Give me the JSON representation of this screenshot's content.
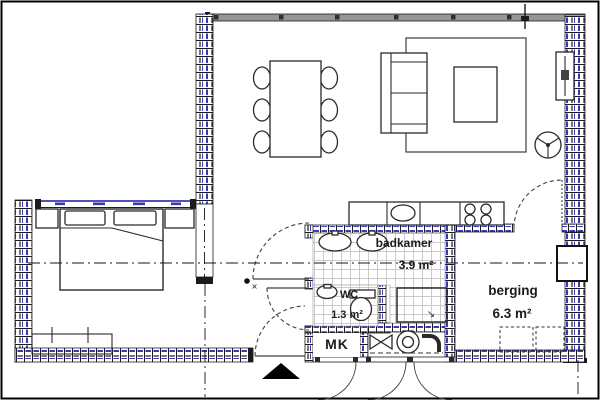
{
  "rooms": {
    "badkamer": {
      "label": "badkamer",
      "area": "3.9 m²"
    },
    "wc": {
      "label": "WC",
      "area": "1.3 m²"
    },
    "berging": {
      "label": "berging",
      "area": "6.3 m²"
    },
    "mk": {
      "label": "MK"
    }
  },
  "symbols": {
    "drain_arrow": "↘",
    "fixture_names": [
      "double-bed",
      "pillow",
      "nightstand",
      "dresser",
      "dining-table",
      "dining-chair",
      "sofa",
      "rug",
      "coffee-table",
      "radiator",
      "ventilation-symbol",
      "kitchen-counter",
      "kitchen-sink",
      "cooktop",
      "washbasin",
      "toilet",
      "shower",
      "boiler-unit",
      "entrance-arrow",
      "door-swing"
    ]
  },
  "colors": {
    "wall_blue": "#3a3ab0",
    "line": "#1b1b1b",
    "window_band": "#969696",
    "tile_line": "#c4c4c4"
  }
}
